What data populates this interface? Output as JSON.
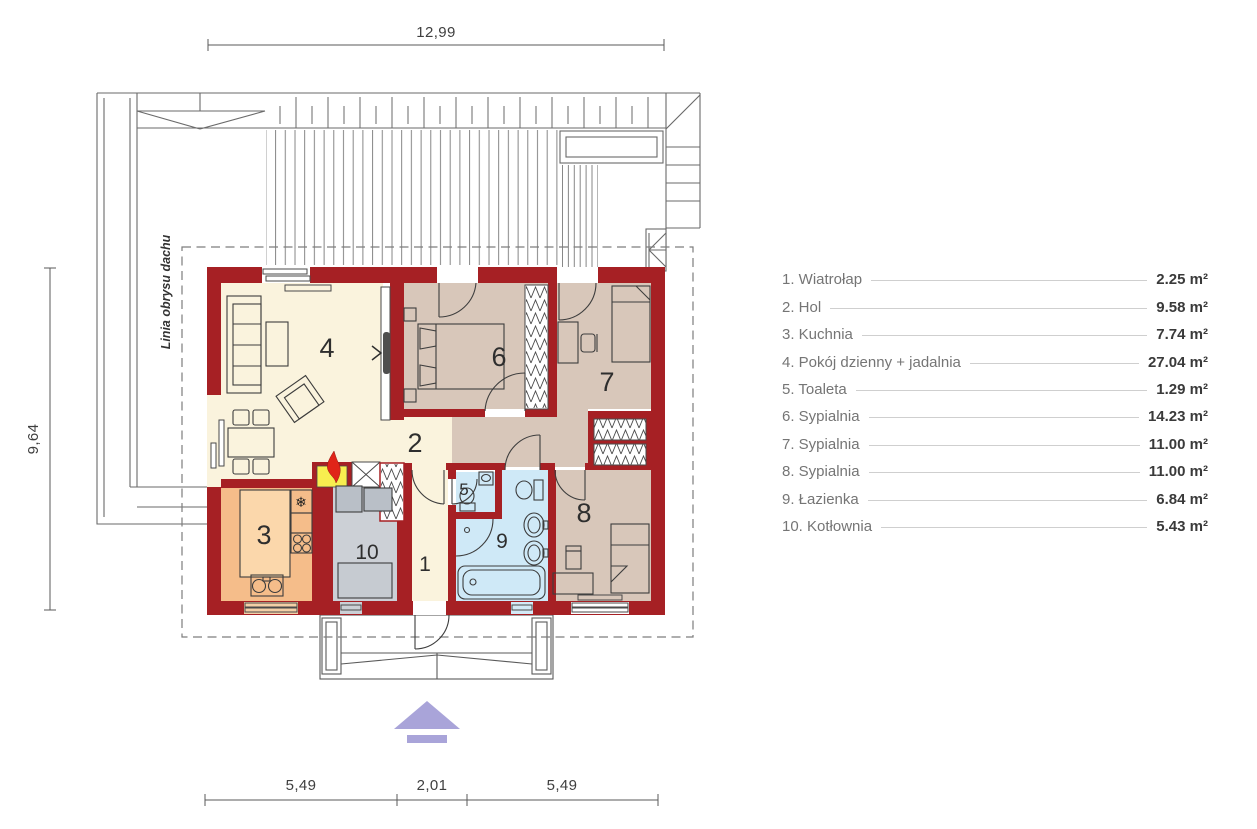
{
  "plan": {
    "rooms": {
      "wiatrolap": "1",
      "hol": "2",
      "kuchnia": "3",
      "pokoj_dzienny": "4",
      "toaleta": "5",
      "sypialnia6": "6",
      "sypialnia7": "7",
      "sypialnia8": "8",
      "lazienka": "9",
      "kotlownia": "10"
    },
    "dimensions": {
      "top": "12,99",
      "left": "9,64",
      "bottom": [
        "5,49",
        "2,01",
        "5,49"
      ]
    },
    "roof_label": "Linia obrysu dachu",
    "colors": {
      "wall_red": "#a62024",
      "floor_cream": "#faf3dd",
      "floor_tan": "#d8c7ba",
      "floor_orange": "#f5bd8a",
      "floor_blue": "#cfe9f7",
      "floor_gray": "#ccd0d6",
      "fireplace_yellow": "#f8ee4f",
      "flame_red": "#e02418",
      "entrance_arrow_purple": "#a9a4d9"
    },
    "icons": {
      "fridge": "snowflake-icon",
      "entrance": "entrance-arrow-icon"
    }
  },
  "legend": {
    "items": [
      {
        "name": "1. Wiatrołap",
        "area": "2.25 m²"
      },
      {
        "name": "2. Hol",
        "area": "9.58 m²"
      },
      {
        "name": "3. Kuchnia",
        "area": "7.74 m²"
      },
      {
        "name": "4. Pokój dzienny + jadalnia",
        "area": "27.04 m²"
      },
      {
        "name": "5. Toaleta",
        "area": "1.29 m²"
      },
      {
        "name": "6. Sypialnia",
        "area": "14.23 m²"
      },
      {
        "name": "7. Sypialnia",
        "area": "11.00 m²"
      },
      {
        "name": "8. Sypialnia",
        "area": "11.00 m²"
      },
      {
        "name": "9. Łazienka",
        "area": "6.84 m²"
      },
      {
        "name": "10. Kotłownia",
        "area": "5.43 m²"
      }
    ]
  }
}
